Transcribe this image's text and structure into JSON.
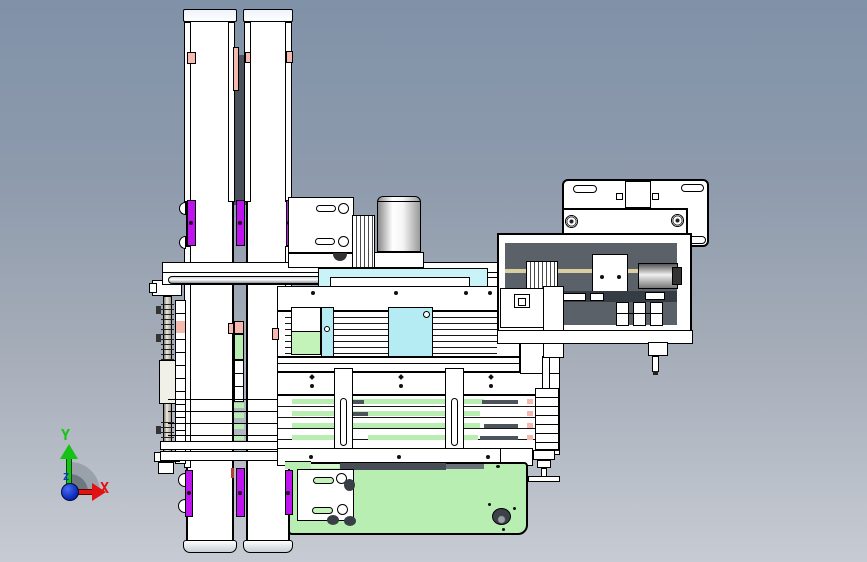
{
  "scene": {
    "type": "cad-assembly-side-view",
    "axis_triad": {
      "label_y": "Y",
      "label_x": "X",
      "label_z": "Z",
      "y_color": "#17c417",
      "x_color": "#e21212",
      "z_color": "#1535cc",
      "origin_color": "#1030c0"
    },
    "palette": {
      "background_top": "#8092a8",
      "background_bottom": "#c7cbd3",
      "part_white": "#ffffff",
      "outline": "#000000",
      "accent_purple": "#bf13ef",
      "accent_pink": "#f5b9af",
      "accent_green": "#b8eeb2",
      "accent_cyan": "#b5ecf4",
      "plate_cyan": "#c9f3f6",
      "panel_dark": "#5a6169",
      "bar_dark": "#474d55",
      "rod_tan": "#dbcfa0"
    }
  }
}
